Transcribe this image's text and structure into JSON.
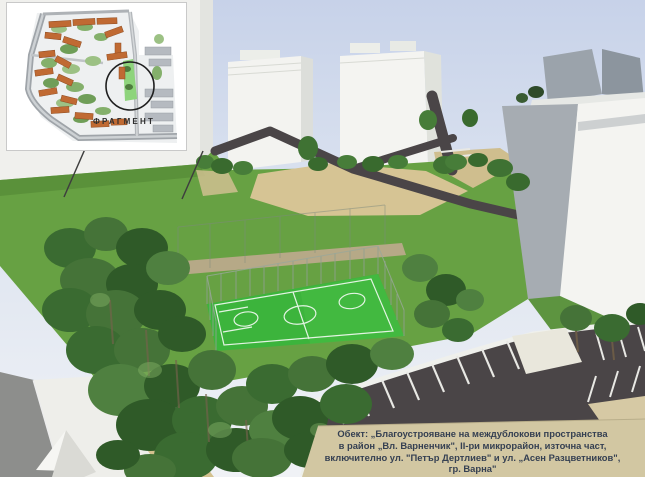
{
  "inset": {
    "label": "ФРАГМЕНТ"
  },
  "caption": {
    "line1": "Обект: „Благоустрояване на междублокови пространства",
    "line2": "в район „Вл. Варненчик\", II-ри микрорайон, източна част,",
    "line3": "включително ул. \"Петър Дертлиев\" и ул. „Асен Разцветников\",",
    "line4": "гр. Варна\""
  },
  "colors": {
    "sky_top": "#c7d2e9",
    "sky_bottom": "#f0f2f6",
    "building_white": "#f4f4f1",
    "building_shade": "#a6acb2",
    "lawn_green": "#67a143",
    "field_green": "#3cb43c",
    "field_line_white": "#ffffff",
    "tree_dark": "#2f5a28",
    "asphalt": "#4a4547",
    "path_beige": "#d6c494",
    "road_gray": "#8d8e8c",
    "caption_bg": "#d2c7a2",
    "caption_text": "#354052",
    "inset_roof_orange": "#c06a33",
    "inset_road_gray": "#9fa4a9",
    "inset_circle": "#1f1f1f"
  }
}
